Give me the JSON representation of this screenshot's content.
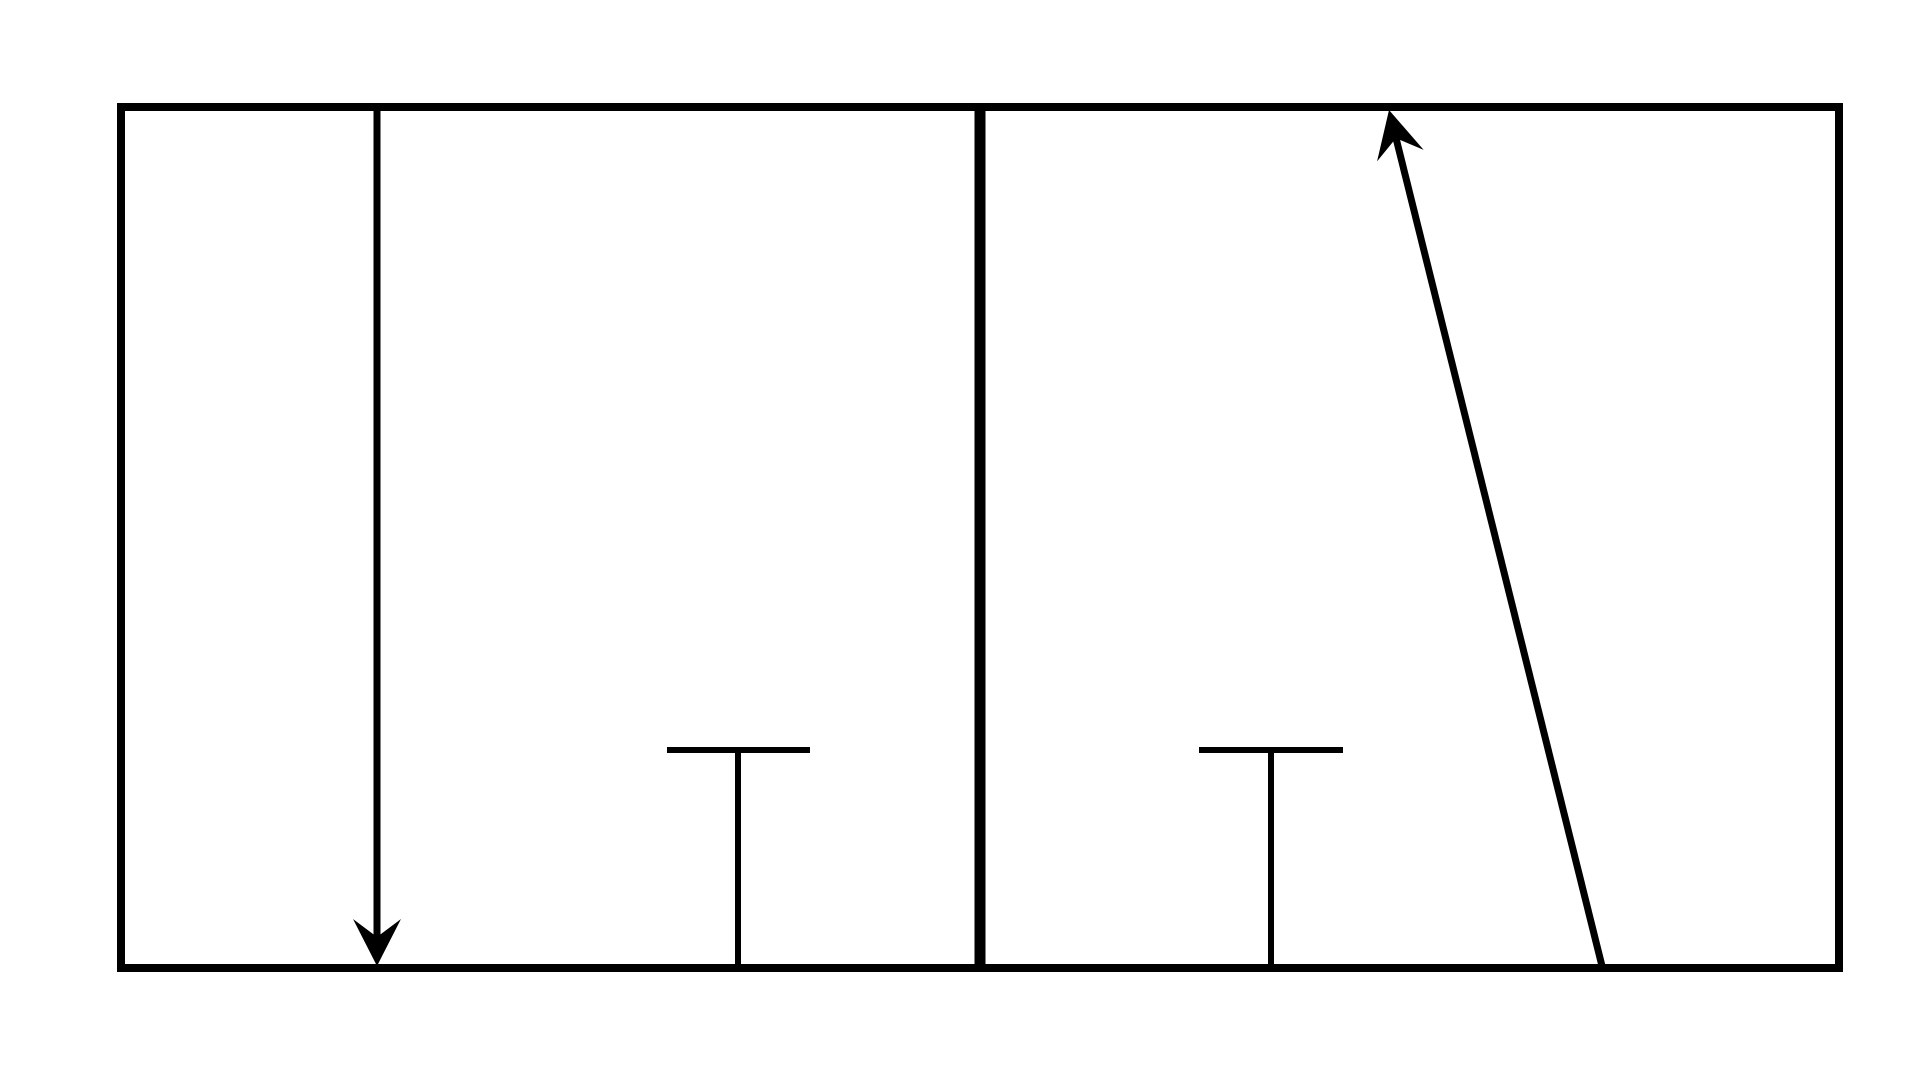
{
  "canvas": {
    "width": 1920,
    "height": 1080,
    "background_color": "#ffffff",
    "stroke_color": "#000000"
  },
  "diagram": {
    "description": "Black line diagram on white: a wide rectangular frame divided into two panels by a thick vertical divider. Left panel: a vertical arrow pointing down to the bottom edge, and a T-shaped mark. Right panel: a T-shaped mark, and a slanted arrow pointing up-left whose tip touches the top edge.",
    "frame": {
      "left": 121,
      "top": 107,
      "right": 1839,
      "bottom": 968,
      "stroke_width": 8
    },
    "divider": {
      "x": 980,
      "top": 107,
      "bottom": 968,
      "stroke_width": 11
    },
    "arrows": [
      {
        "name": "down-arrow",
        "tail": {
          "x": 377,
          "y": 110
        },
        "tip": {
          "x": 377,
          "y": 966
        },
        "stroke_width": 7,
        "head_length": 47,
        "head_half_width": 24,
        "head_notch": 29
      },
      {
        "name": "up-slant-arrow",
        "tail": {
          "x": 1602,
          "y": 966
        },
        "tip": {
          "x": 1389,
          "y": 110
        },
        "stroke_width": 7,
        "head_length": 47,
        "head_half_width": 24,
        "head_notch": 29
      }
    ],
    "tees": [
      {
        "name": "left-tee",
        "bar": {
          "x1": 667,
          "x2": 810,
          "y": 750
        },
        "stem": {
          "x": 738,
          "y1": 750,
          "y2": 966
        },
        "stroke_width": 6
      },
      {
        "name": "right-tee",
        "bar": {
          "x1": 1199,
          "x2": 1343,
          "y": 750
        },
        "stem": {
          "x": 1271,
          "y1": 750,
          "y2": 966
        },
        "stroke_width": 6
      }
    ]
  }
}
